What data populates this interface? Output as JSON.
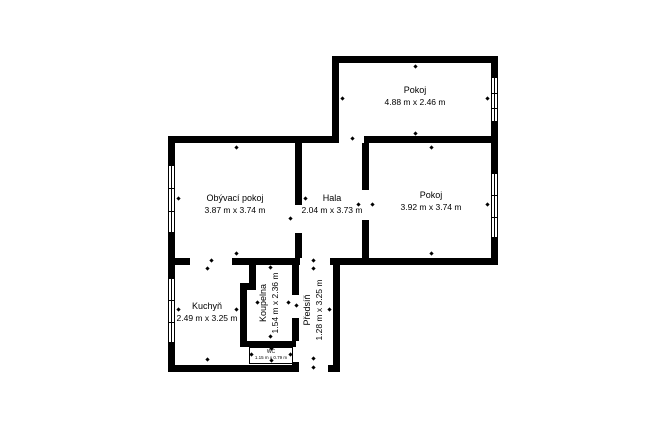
{
  "floorplan": {
    "rooms": {
      "pokoj_top": {
        "name": "Pokoj",
        "dims": "4.88 m x 2.46 m"
      },
      "obyvaci_pokoj": {
        "name": "Obývací pokoj",
        "dims": "3.87 m x 3.74 m"
      },
      "hala": {
        "name": "Hala",
        "dims": "2.04 m x 3.73 m"
      },
      "pokoj_right": {
        "name": "Pokoj",
        "dims": "3.92 m x 3.74 m"
      },
      "kuchyn": {
        "name": "Kuchyň",
        "dims": "2.49 m x 3.25 m"
      },
      "koupelna": {
        "name": "Koupelna",
        "dims": "1.54 m x 2.36 m"
      },
      "predsin": {
        "name": "Předsíň",
        "dims": "1.28 m x 3.25 m"
      },
      "wc": {
        "name": "WC",
        "dims": "1.15 m x 0.79 m"
      }
    },
    "colors": {
      "wall": "#000000",
      "background": "#ffffff"
    }
  }
}
